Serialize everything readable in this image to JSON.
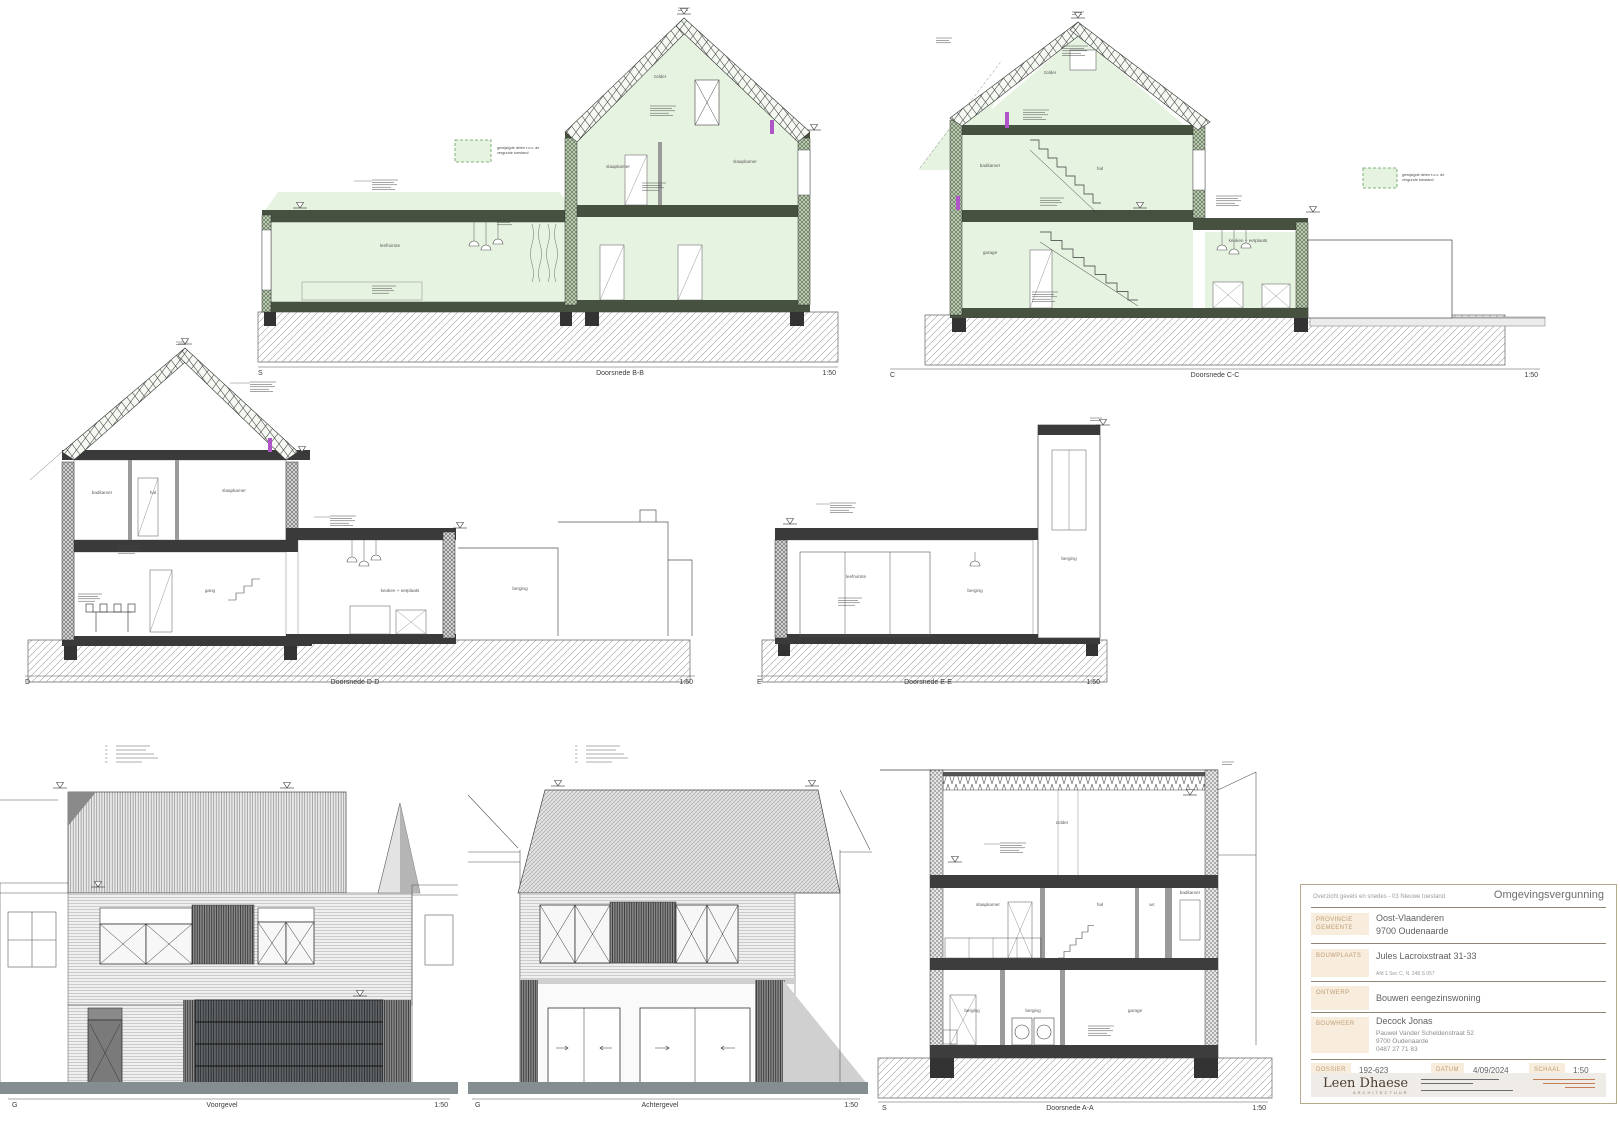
{
  "sheet": {
    "name": "Overzicht gevels en snedes"
  },
  "legend": {
    "line1": "gewijzigde delen t.o.v. de",
    "line2": "vergunde toestand",
    "swatch_color": "#e7f3e1",
    "swatch_border": "#5d9e57"
  },
  "drawings": {
    "bb": {
      "marker": "S",
      "title": "Doorsnede B-B",
      "scale": "1:50",
      "rooms": {
        "attic": "zolder",
        "up_left": "slaapkamer",
        "up_right": "slaapkamer",
        "gnd_left": "leefruimte"
      }
    },
    "cc": {
      "marker": "C",
      "title": "Doorsnede C-C",
      "scale": "1:50",
      "rooms": {
        "attic": "zolder",
        "up_left": "badkamer",
        "up_mid": "hal",
        "gnd_left": "garage",
        "gnd_right": "keuken + eetplaats"
      }
    },
    "dd": {
      "marker": "D",
      "title": "Doorsnede D-D",
      "scale": "1:50",
      "rooms": {
        "up_left": "badkamer",
        "up_mid": "hal",
        "up_right": "slaapkamer",
        "gnd_left": "gang",
        "gnd_mid": "keuken + eetplaats",
        "gnd_right": "berging"
      }
    },
    "ee": {
      "marker": "E",
      "title": "Doorsnede E-E",
      "scale": "1:50",
      "rooms": {
        "main": "leefruimte",
        "right": "berging",
        "bay": "berging"
      }
    },
    "aa": {
      "marker": "S",
      "title": "Doorsnede A-A",
      "scale": "1:50",
      "rooms": {
        "attic": "zolder",
        "up_left": "slaapkamer",
        "up_mid": "hal",
        "up_wc": "wc",
        "up_right": "badkamer",
        "gnd_left": "berging",
        "gnd_mid": "berging",
        "gnd_right": "garage"
      }
    },
    "voorgevel": {
      "marker": "G",
      "title": "Voorgevel",
      "scale": "1:50"
    },
    "achtergevel": {
      "marker": "G",
      "title": "Achtergevel",
      "scale": "1:50"
    }
  },
  "titleblock": {
    "note": "Overzicht gevels en snedes - 03 Nieuwe toestand",
    "permit": "Omgevingsvergunning",
    "provincie_label": "PROVINCIE",
    "gemeente_label": "GEMEENTE",
    "provincie": "Oost-Vlaanderen",
    "gemeente": "9700 Oudenaarde",
    "bouwplaats_label": "BOUWPLAATS",
    "bouwplaats": "Jules Lacroixstraat 31-33",
    "kadaster": "Afd 1 Sec C, N. 248 S 057",
    "ontwerp_label": "ONTWERP",
    "ontwerp": "Bouwen eengezinswoning",
    "bouwheer_label": "BOUWHEER",
    "bouwheer": "Decock Jonas",
    "bouwheer_adres1": "Pauwel Vander Scheldenstraat 52",
    "bouwheer_adres2": "9700 Oudenaarde",
    "bouwheer_tel": "0487 27 71 83",
    "dossier_label": "DOSSIER",
    "dossier": "192-623",
    "datum_label": "DATUM",
    "datum": "4/09/2024",
    "schaal_label": "SCHAAL",
    "schaal": "1:50",
    "logo": "Leen Dhaese",
    "logo_sub": "ARCHITECTUUR"
  }
}
